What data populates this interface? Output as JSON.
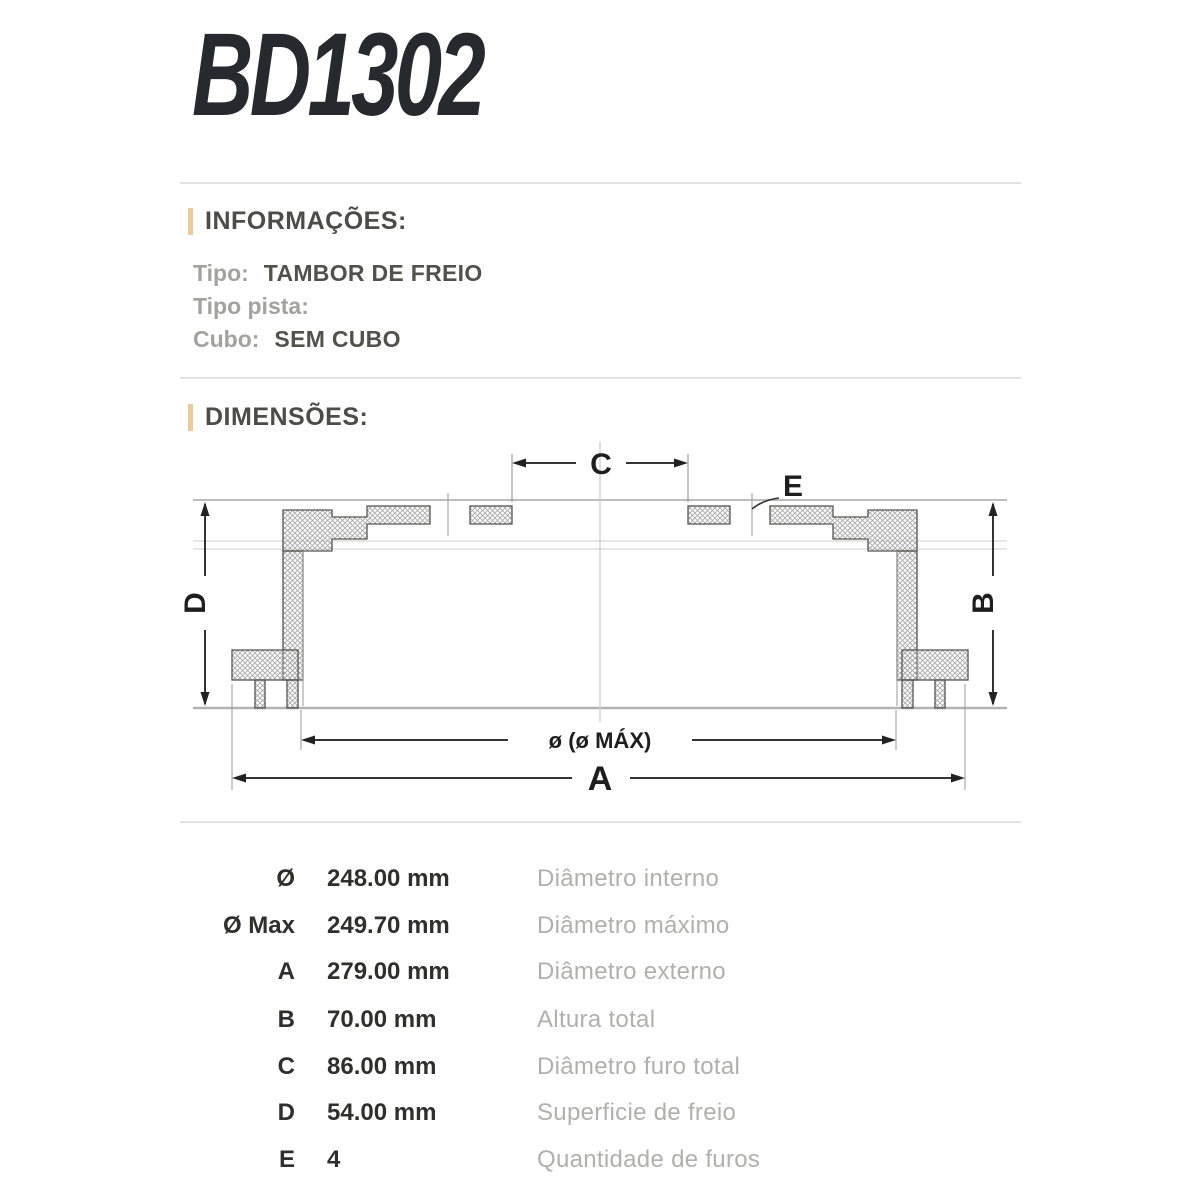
{
  "page": {
    "title": "BD1302"
  },
  "colors": {
    "accent_bar": "#eccaa1",
    "heading_text": "#4c4c48",
    "label_gray": "#a2a2a0",
    "value_dark": "#52524c",
    "desc_gray": "#b0b0ae",
    "title_color": "#26292e",
    "separator": "#e4e2e0"
  },
  "info": {
    "heading": "INFORMAÇÕES:",
    "fields": [
      {
        "label": "Tipo:",
        "value": "TAMBOR DE FREIO"
      },
      {
        "label": "Tipo pista:",
        "value": ""
      },
      {
        "label": "Cubo:",
        "value": "SEM CUBO"
      }
    ]
  },
  "dimensions": {
    "heading": "DIMENSÕES:",
    "diagram": {
      "c": "C",
      "e": "E",
      "d": "D",
      "b": "B",
      "a": "A",
      "diameter": "ø (ø MÁX)"
    },
    "rows": [
      {
        "symbol": "Ø",
        "value": "248.00 mm",
        "description": "Diâmetro interno"
      },
      {
        "symbol": "Ø Max",
        "value": "249.70 mm",
        "description": "Diâmetro máximo"
      },
      {
        "symbol": "A",
        "value": "279.00 mm",
        "description": "Diâmetro externo"
      },
      {
        "symbol": "B",
        "value": "70.00 mm",
        "description": "Altura total"
      },
      {
        "symbol": "C",
        "value": "86.00 mm",
        "description": "Diâmetro furo total"
      },
      {
        "symbol": "D",
        "value": "54.00 mm",
        "description": "Superficie de freio"
      },
      {
        "symbol": "E",
        "value": "4",
        "description": "Quantidade de furos"
      }
    ]
  }
}
